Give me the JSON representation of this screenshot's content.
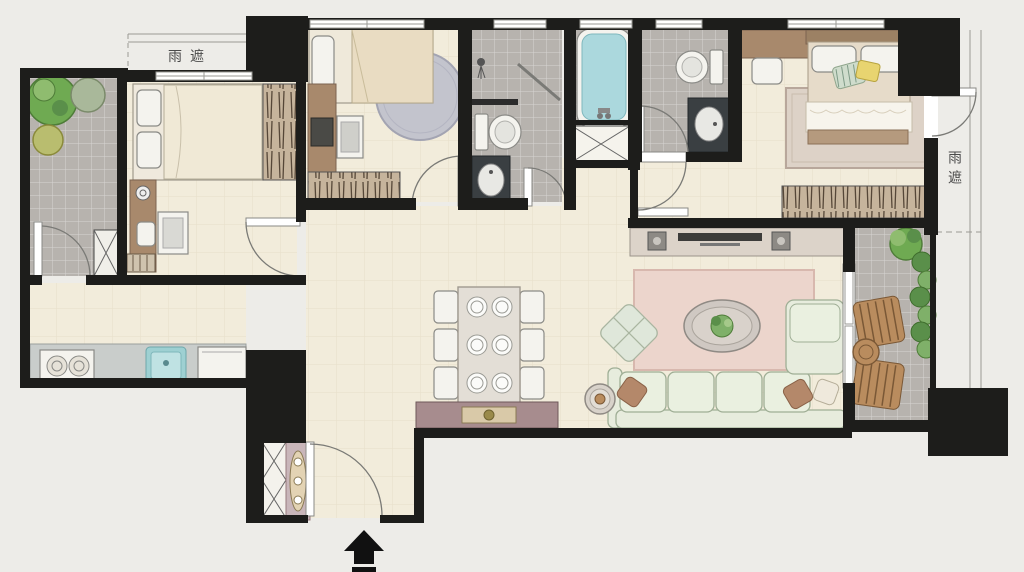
{
  "labels": {
    "rain_shelter_top": "雨遮",
    "rain_shelter_right": "雨遮"
  },
  "icons": {
    "entry_arrow": "▲",
    "plant": "●",
    "door_swing": "◜"
  },
  "colors": {
    "wall": "#1d1d1b",
    "floor": "#f2ecdb",
    "tile": "#b7b3ae",
    "wood": "#a8896c",
    "wood_dark": "#7c6350",
    "counter": "#c9cdcb",
    "water": "#abd8dd",
    "sofa": "#e7ecdd",
    "sofa_line": "#9fae95",
    "rug_pink": "#ecd5cc",
    "marble": "#dcd3c9",
    "mauve": "#a78c8e",
    "plant": "#6faa52",
    "plant_dark": "#4e7c38",
    "outdoor_wood": "#b98c5e",
    "fixture": "#f4f3ee",
    "dark_vanity": "#3a3f42",
    "label": "#4a4a4a",
    "paper": "#edece8",
    "arrow": "#111111"
  }
}
